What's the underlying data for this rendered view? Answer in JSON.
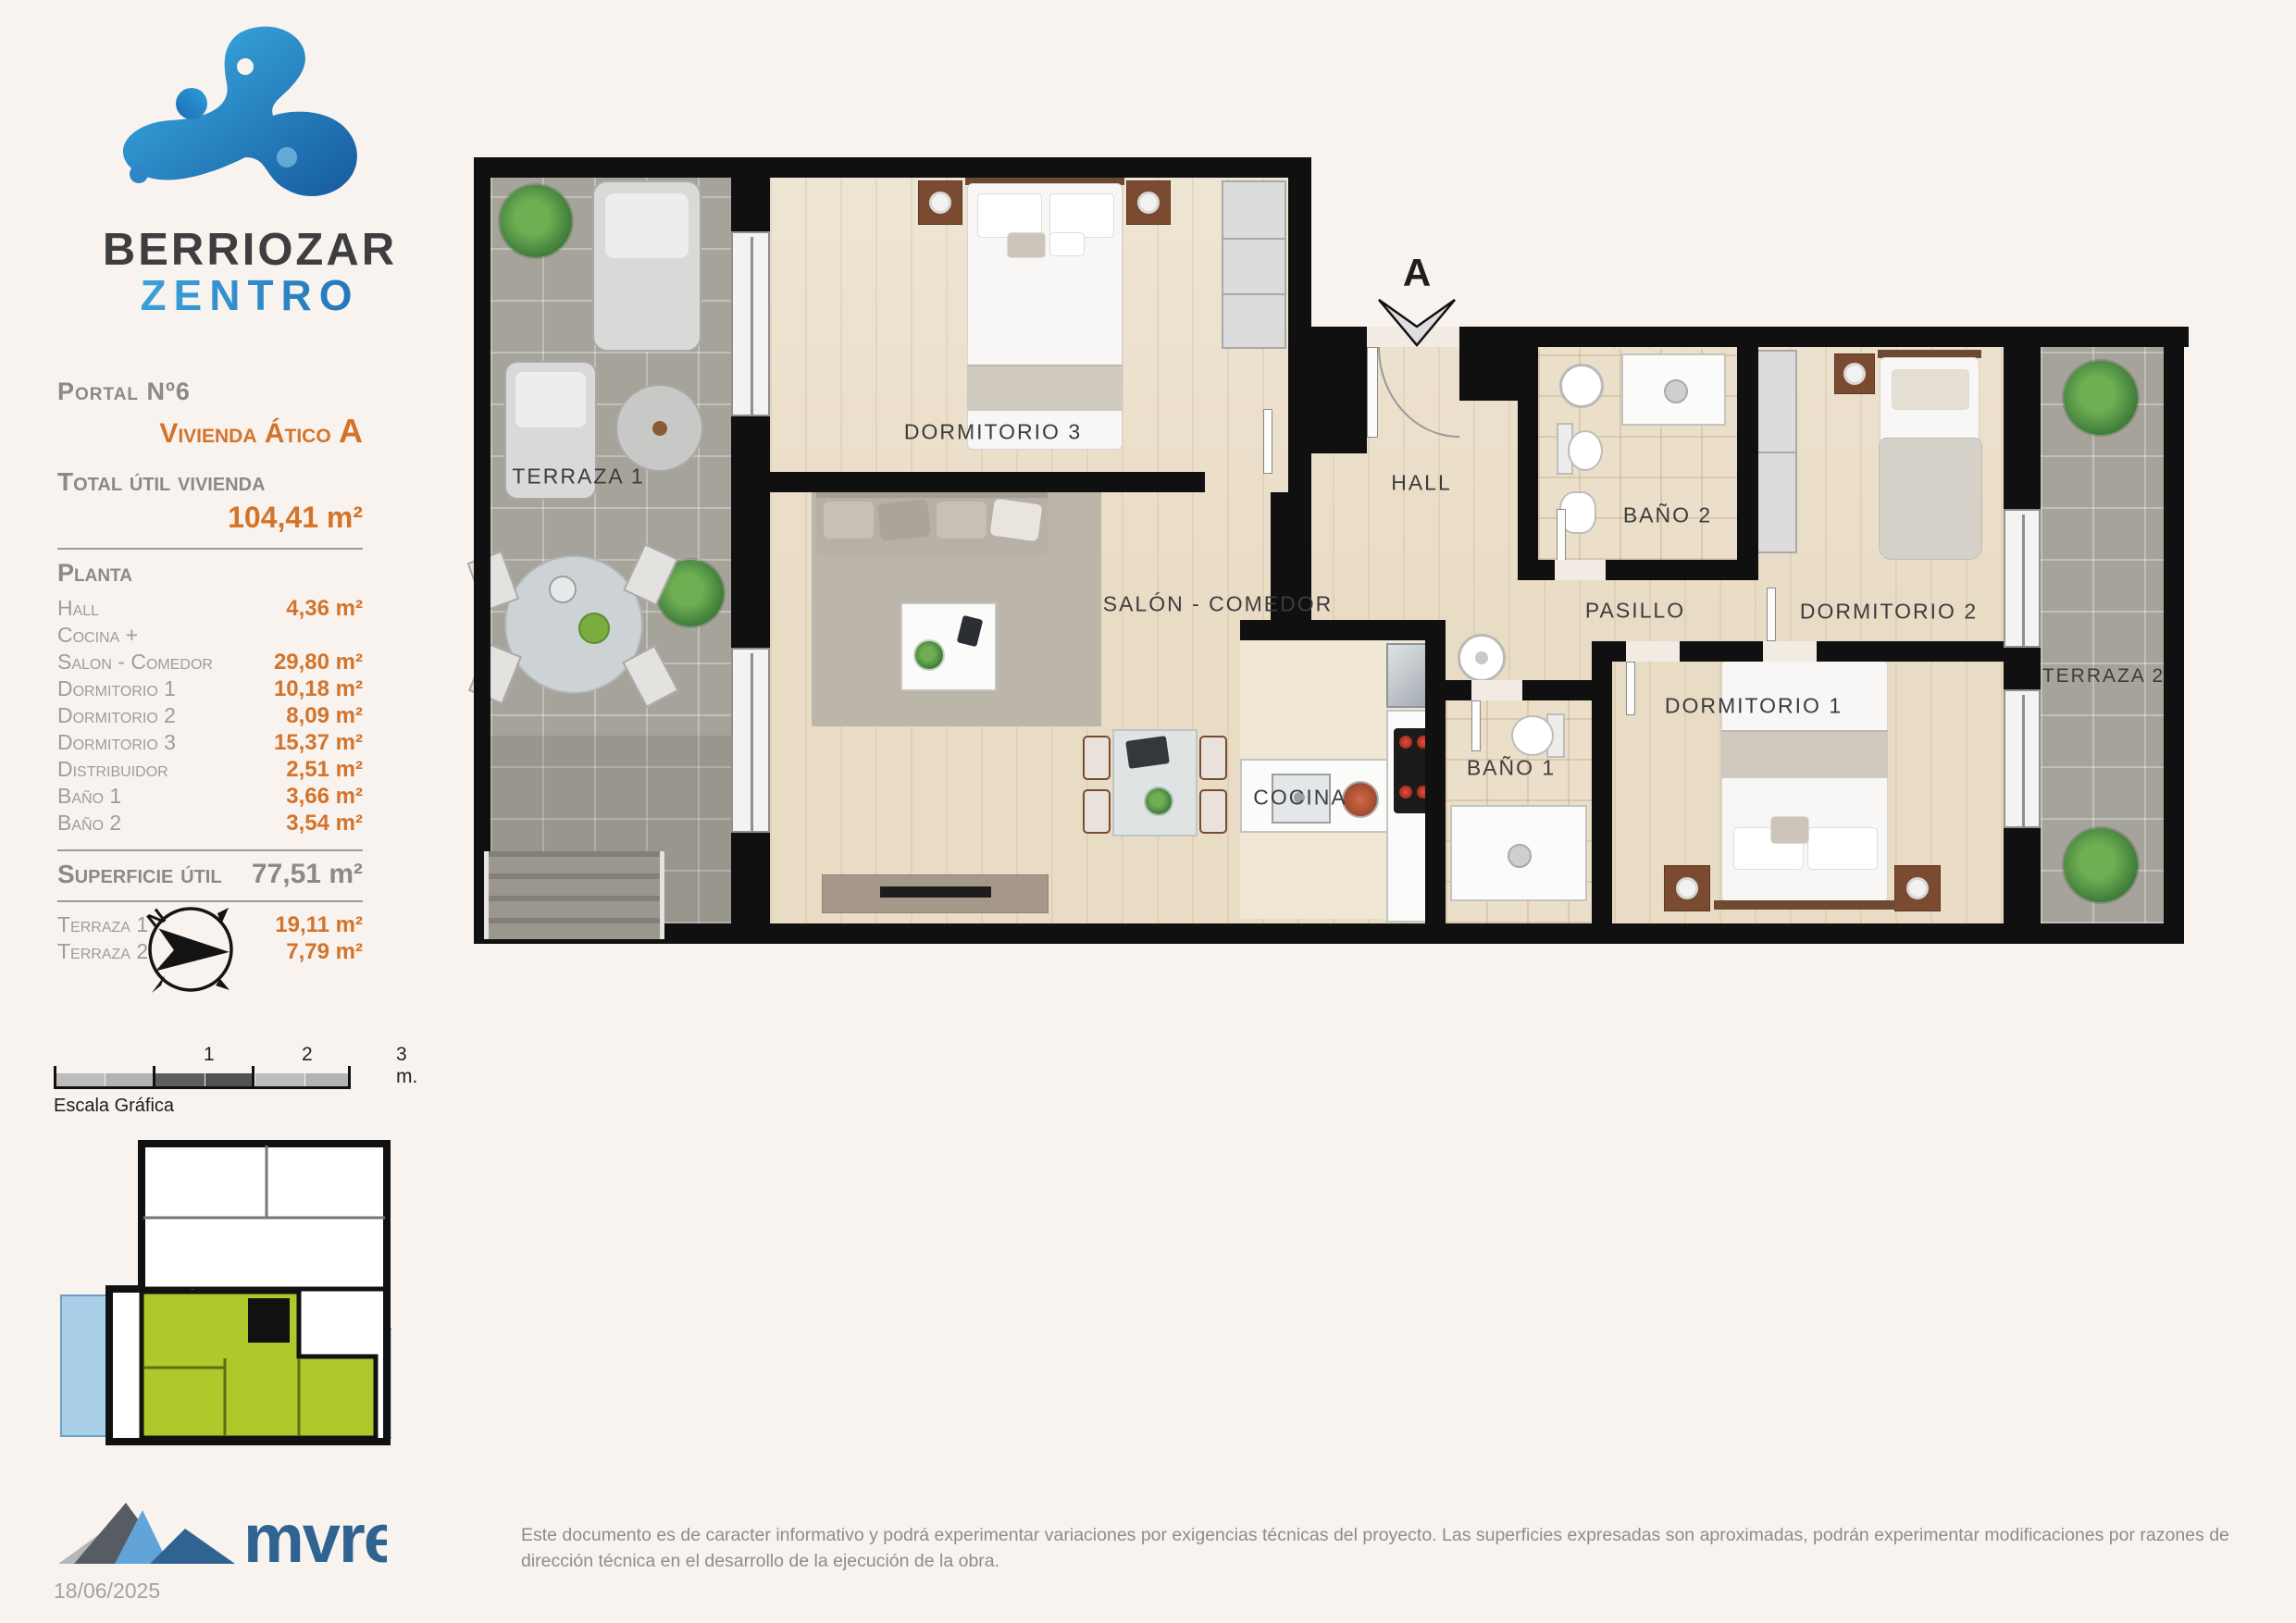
{
  "branding": {
    "name_top": "BERRIOZAR",
    "name_bottom": "ZENTRO"
  },
  "info": {
    "portal": "Portal Nº6",
    "vivienda_prefix": "Vivienda Ático ",
    "vivienda_letter": "A",
    "total_label": "Total útil vivienda",
    "total_value": "104,41 m²",
    "planta_label": "Planta",
    "rows": [
      {
        "label": "Hall",
        "value": "4,36 m²"
      },
      {
        "label": "Cocina +",
        "value": ""
      },
      {
        "label": "Salon - Comedor",
        "value": "29,80 m²"
      },
      {
        "label": "Dormitorio 1",
        "value": "10,18 m²"
      },
      {
        "label": "Dormitorio 2",
        "value": "8,09 m²"
      },
      {
        "label": "Dormitorio 3",
        "value": "15,37 m²"
      },
      {
        "label": "Distribuidor",
        "value": "2,51 m²"
      },
      {
        "label": "Baño 1",
        "value": "3,66 m²"
      },
      {
        "label": "Baño 2",
        "value": "3,54 m²"
      }
    ],
    "superficie_label": "Superficie útil",
    "superficie_value": "77,51 m²",
    "terraza_rows": [
      {
        "label": "Terraza 1",
        "value": "19,11 m²"
      },
      {
        "label": "Terraza 2",
        "value": "7,79 m²"
      }
    ]
  },
  "plan": {
    "rooms": {
      "terraza1": "TERRAZA 1",
      "dormitorio3": "DORMITORIO 3",
      "hall": "HALL",
      "bano2": "BAÑO 2",
      "dormitorio2": "DORMITORIO 2",
      "terraza2": "TERRAZA 2",
      "pasillo": "PASILLO",
      "salon": "SALÓN - COMEDOR",
      "cocina": "COCINA",
      "bano1": "BAÑO 1",
      "dormitorio1": "DORMITORIO 1"
    },
    "section_marker": "A",
    "compass_n": "N"
  },
  "scalebar": {
    "ticks": [
      "1",
      "2",
      "3 m."
    ],
    "caption": "Escala Gráfica"
  },
  "footer": {
    "logo_text": "mvre",
    "date": "18/06/2025",
    "disclaimer": "Este documento es de caracter informativo y podrá experimentar variaciones por exigencias técnicas del proyecto. Las superficies expresadas son aproximadas, podrán experimentar modificaciones por razones de dirección técnica en el desarrollo de la ejecución de la obra."
  },
  "colors": {
    "accent_orange": "#d4732a",
    "brand_blue": "#2d8fd0",
    "wall_black": "#101010",
    "wood_floor": "#e9dcc5",
    "terrace_tile": "#a6a39b",
    "bath_tile": "#ecdfc9",
    "keyplan_green": "#aec92c",
    "keyplan_blue": "#a9cfe9"
  }
}
